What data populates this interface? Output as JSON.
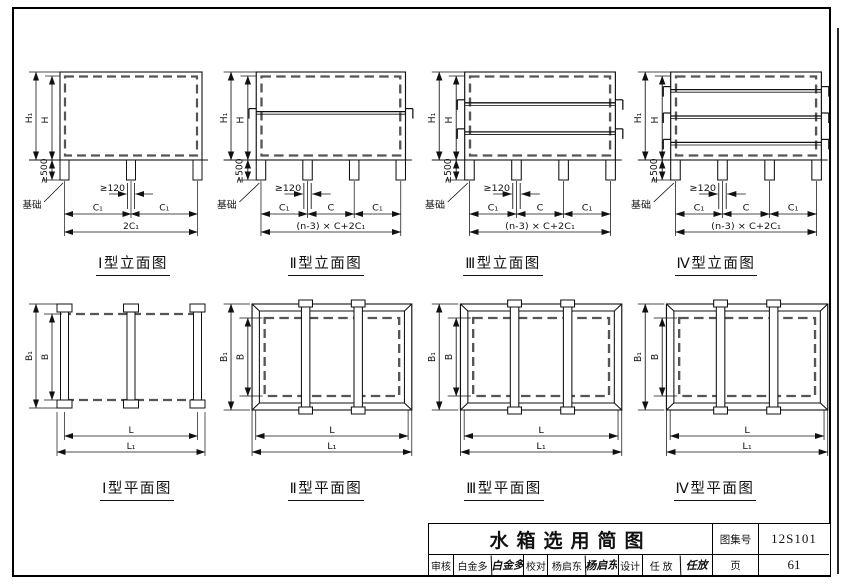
{
  "drawing": {
    "elevations": [
      {
        "key": "I",
        "title": "Ⅰ型立面图",
        "legs": 3,
        "tie_positions": [],
        "dims": {
          "h1": "H₁",
          "h": "H",
          "base_h": "≥500",
          "foundation": "基础",
          "rail_gap": "≥120",
          "spans": [
            "C₁",
            "C₁"
          ],
          "total": "2C₁"
        }
      },
      {
        "key": "II",
        "title": "Ⅱ型立面图",
        "legs": 4,
        "tie_positions": [
          0.45
        ],
        "dims": {
          "h1": "H₁",
          "h": "H",
          "base_h": "≥500",
          "foundation": "基础",
          "rail_gap": "≥120",
          "spans": [
            "C₁",
            "C",
            "C₁"
          ],
          "total": "(n-3) × C+2C₁"
        }
      },
      {
        "key": "III",
        "title": "Ⅲ型立面图",
        "legs": 4,
        "tie_positions": [
          0.35,
          0.68
        ],
        "dims": {
          "h1": "H₁",
          "h": "H",
          "base_h": "≥500",
          "foundation": "基础",
          "rail_gap": "≥120",
          "spans": [
            "C₁",
            "C",
            "C₁"
          ],
          "total": "(n-3) × C+2C₁"
        }
      },
      {
        "key": "IV",
        "title": "Ⅳ型立面图",
        "legs": 4,
        "tie_positions": [
          0.2,
          0.5,
          0.8
        ],
        "dims": {
          "h1": "H₁",
          "h": "H",
          "base_h": "≥500",
          "foundation": "基础",
          "rail_gap": "≥120",
          "spans": [
            "C₁",
            "C",
            "C₁"
          ],
          "total": "(n-3) × C+2C₁"
        }
      }
    ],
    "plans": [
      {
        "key": "I",
        "title": "Ⅰ型平面图",
        "variant": "rails",
        "rails": 3,
        "dims": {
          "b1": "B₁",
          "b": "B",
          "l": "L",
          "l1": "L₁"
        }
      },
      {
        "key": "II",
        "title": "Ⅱ型平面图",
        "variant": "frame",
        "rails": 2,
        "dims": {
          "b1": "B₁",
          "b": "B",
          "l": "L",
          "l1": "L₁"
        }
      },
      {
        "key": "III",
        "title": "Ⅲ型平面图",
        "variant": "frame",
        "rails": 2,
        "dims": {
          "b1": "B₁",
          "b": "B",
          "l": "L",
          "l1": "L₁"
        }
      },
      {
        "key": "IV",
        "title": "Ⅳ型平面图",
        "variant": "frame",
        "rails": 2,
        "dims": {
          "b1": "B₁",
          "b": "B",
          "l": "L",
          "l1": "L₁"
        }
      }
    ]
  },
  "titleblock": {
    "title": "水箱选用简图",
    "atlas_label": "图集号",
    "atlas_no": "12S101",
    "page_label": "页",
    "page_no": "61",
    "staff": [
      {
        "role": "审核",
        "name": "白金多",
        "signature": "白金多"
      },
      {
        "role": "校对",
        "name": "杨启东",
        "signature": "杨启东"
      },
      {
        "role": "设计",
        "name": "任 放",
        "signature": "任放"
      }
    ]
  }
}
